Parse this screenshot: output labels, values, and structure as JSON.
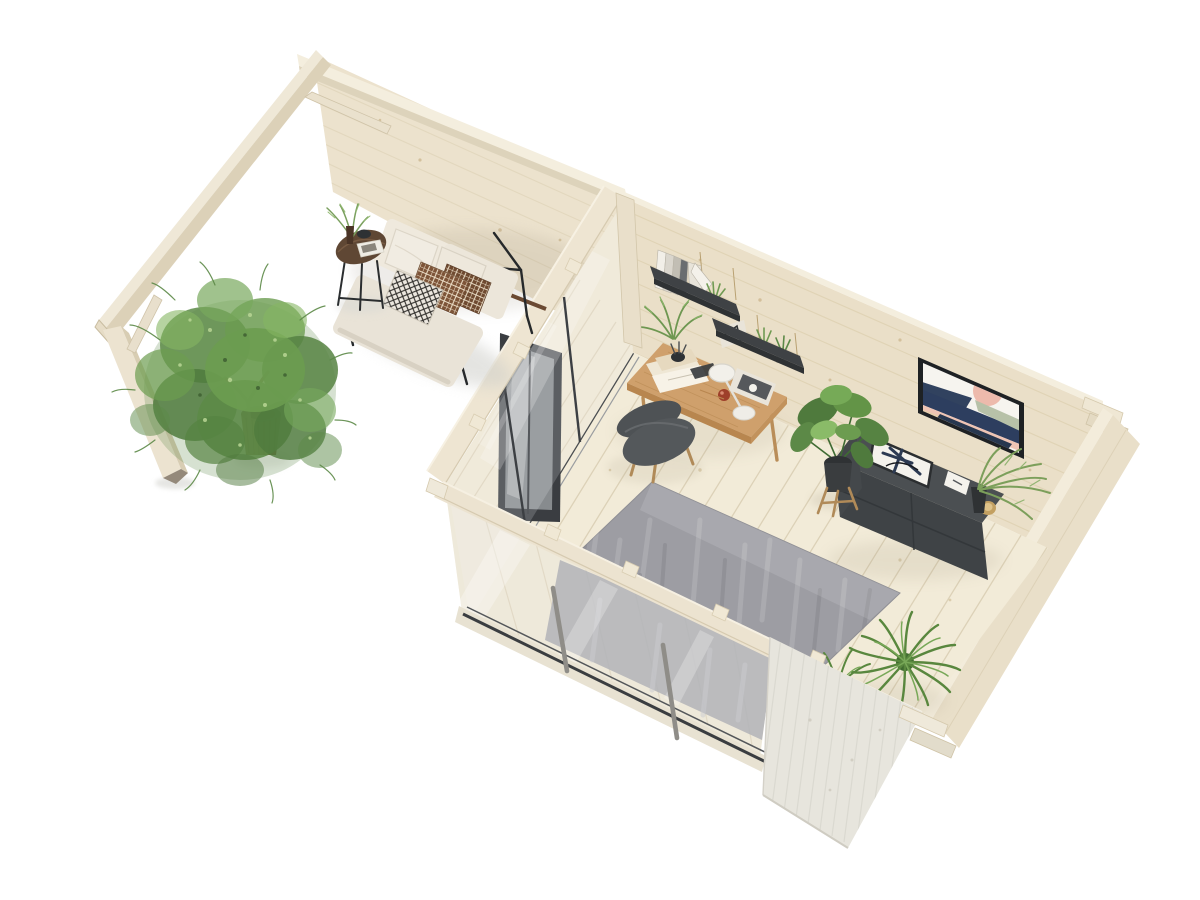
{
  "meta": {
    "type": "3d-render",
    "subject": "log-cabin garden office with pergola, aerial cutaway view",
    "width": 1200,
    "height": 900
  },
  "palette": {
    "background": "#ffffff",
    "wall_wood": "#ece2cd",
    "wall_wood_back": "#eadfc8",
    "wall_top": "#f4eede",
    "wall_interior_right": "#e4d9c1",
    "wall_exterior_right": "#e9dfc9",
    "beam": "#efe8d7",
    "beam_side": "#dcd1b8",
    "floor": "#f2ebd8",
    "plank_line": "#d9cdb2",
    "rug": "#9d9da3",
    "rug_light": "#b7b7bc",
    "rug_dark": "#85858c",
    "glass": "#eef3f5",
    "frame_dark": "#3a3d41",
    "mullion_gray": "#8f8d88",
    "exterior_wood": "#e7e5dd",
    "exterior_streak": "#d8d6ce",
    "desk": "#cfa06c",
    "desk_edge": "#b8864f",
    "chair": "#54585b",
    "chair_leg": "#b08a58",
    "furniture_dark": "#4b4f52",
    "furniture_front": "#3f4346",
    "shelf_dark": "#3f4245",
    "sofa": "#e9e3d7",
    "sofa_back": "#efe9dd",
    "pillow_white": "#f1ece2",
    "pillow_brown": "#7d5438",
    "pillow_brown2": "#6f4a30",
    "pillow_grid": "#e9dbc4",
    "bw_base": "#ece7df",
    "bw_line": "#2e2c29",
    "table_top": "#5f4734",
    "leaf_dark": "#4f7a3d",
    "leaf_mid": "#5c8947",
    "leaf_mid2": "#6c9c50",
    "leaf_light": "#85b563",
    "fern_green": "#59873e",
    "fern_light": "#78a858",
    "pot_wicker": "#7d5735",
    "pot_dark": "#34373a",
    "metal_black": "#26292b",
    "art_navy": "#2d3e5f",
    "art_navy2": "#27374f",
    "art_pink": "#edbaac",
    "art_blush": "#eec4b4",
    "art_sage": "#b7c1a8",
    "mat_white": "#f6f4ef",
    "gold": "#c3a061",
    "trim_brown": "#6b4a33",
    "soft_shadow": "#cfcfca"
  },
  "scene": {
    "areas": [
      {
        "label": "pergola-terrace",
        "objects": [
          "pergola-frame",
          "potted-tree",
          "loveseat-sofa",
          "side-table"
        ]
      },
      {
        "label": "office-room",
        "objects": [
          "desk",
          "desk-chair",
          "gray-rug",
          "wall-shelves",
          "framed-art",
          "sideboard",
          "monstera-plant",
          "corner-ferns",
          "sliding-glass-door",
          "glass-front-wall"
        ]
      }
    ]
  }
}
